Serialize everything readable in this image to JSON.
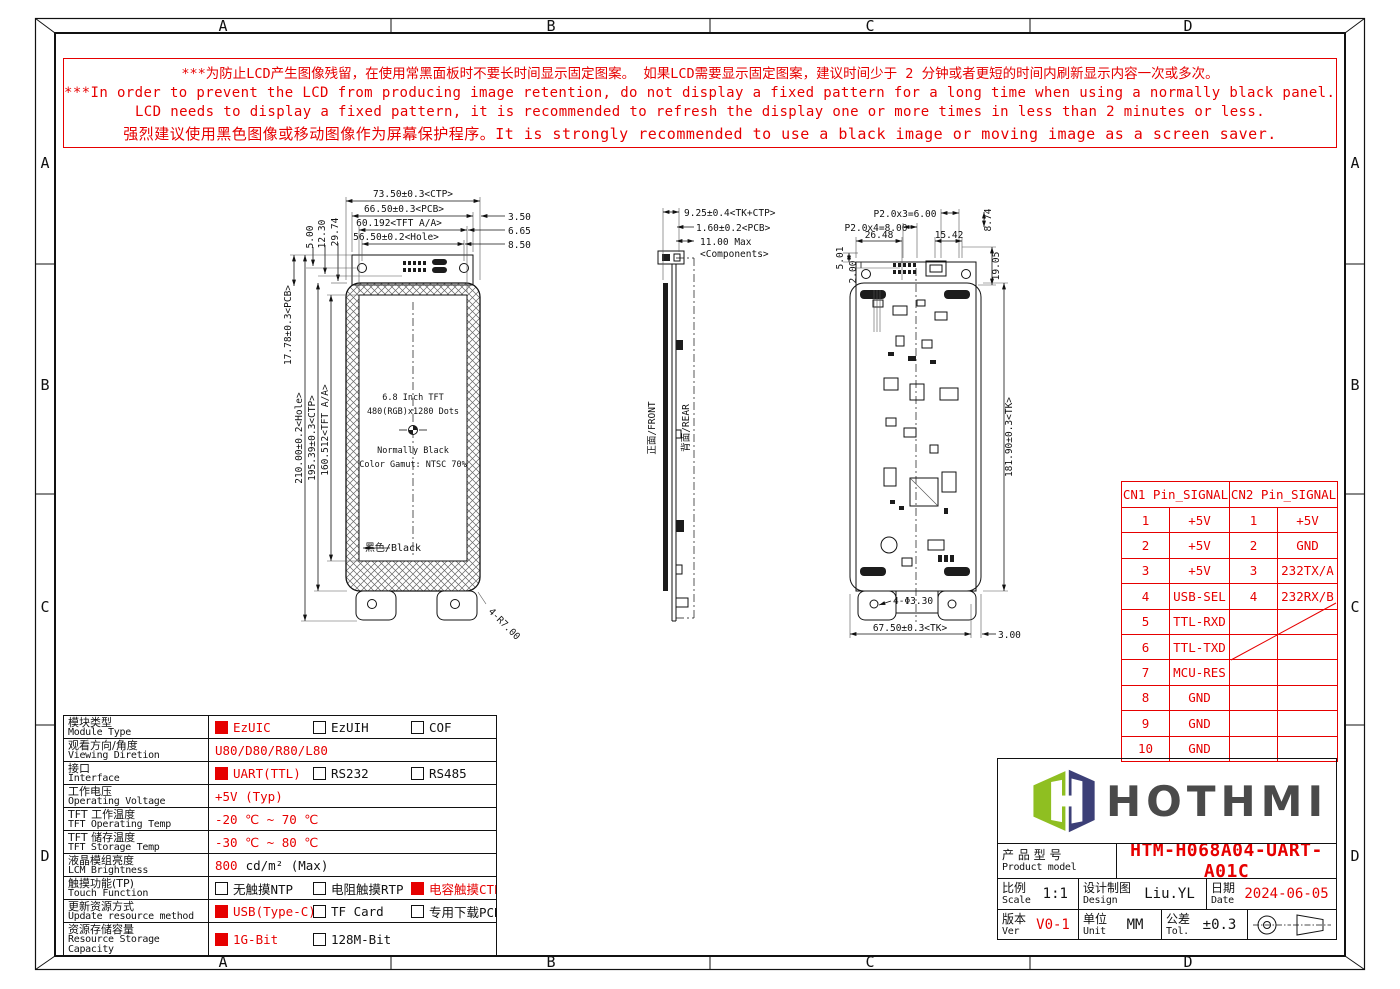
{
  "frame": {
    "cols": [
      "A",
      "B",
      "C",
      "D"
    ],
    "rows": [
      "A",
      "B",
      "C",
      "D"
    ]
  },
  "warning": {
    "line1": "***为防止LCD产生图像残留，在使用常黑面板时不要长时间显示固定图案。 如果LCD需要显示固定图案，建议时间少于 2 分钟或者更短的时间内刷新显示内容一次或多次。",
    "line2": "***In order to prevent the LCD from producing image retention, do not display a fixed pattern for a long time when using a normally black panel. If the",
    "line3": "LCD needs to display a fixed pattern, it is recommended to refresh the display one or more times in less than 2 minutes or less.",
    "line4": "强烈建议使用黑色图像或移动图像作为屏幕保护程序。It is strongly recommended to use a black image or moving image as a screen saver."
  },
  "front_view": {
    "dim_ctp": "73.50±0.3<CTP>",
    "dim_pcb": "66.50±0.3<PCB>",
    "dim_aa": "60.192<TFT A/A>",
    "dim_hole": "56.50±0.2<Hole>",
    "off1": "3.50",
    "off2": "6.65",
    "off3": "8.50",
    "v1": "5.00",
    "v2": "12.30",
    "v3": "29.74",
    "left1": "17.78±0.3<PCB>",
    "left2": "210.00±0.2<Hole>",
    "left3": "195.39±0.3<CTP>",
    "left4": "160.512<TFT A/A>",
    "screen1": "6.8 Inch TFT",
    "screen2": "480(RGB)x1280 Dots",
    "screen3": "Normally Black",
    "screen4": "Color Gamut: NTSC 70%",
    "black_label": "黑色/Black",
    "corner": "4-R7.00"
  },
  "side_view": {
    "dim1": "9.25±0.4<TK+CTP>",
    "dim2": "1.60±0.2<PCB>",
    "dim3": "11.00 Max",
    "dim3b": "<Components>",
    "front": "正面/FRONT",
    "rear": "背面/REAR"
  },
  "rear_view": {
    "p1": "P2.0x3=6.00",
    "p2": "P2.0x4=8.00",
    "d1": "26.48",
    "d2": "15.42",
    "d3": "8.74",
    "d4": "19.05",
    "d5": "5.01",
    "d6": "2.00",
    "right": "181.90±0.3<TK>",
    "hole": "4-Φ3.30",
    "bottom": "67.50±0.3<TK>",
    "off": "3.00"
  },
  "pin_table": {
    "h1": "CN1 Pin_SIGNAL",
    "h2": "CN2 Pin_SIGNAL",
    "cn1": [
      [
        "1",
        "+5V"
      ],
      [
        "2",
        "+5V"
      ],
      [
        "3",
        "+5V"
      ],
      [
        "4",
        "USB-SEL"
      ],
      [
        "5",
        "TTL-RXD"
      ],
      [
        "6",
        "TTL-TXD"
      ],
      [
        "7",
        "MCU-RES"
      ],
      [
        "8",
        "GND"
      ],
      [
        "9",
        "GND"
      ],
      [
        "10",
        "GND"
      ]
    ],
    "cn2": [
      [
        "1",
        "+5V"
      ],
      [
        "2",
        "GND"
      ],
      [
        "3",
        "232TX/A"
      ],
      [
        "4",
        "232RX/B"
      ]
    ]
  },
  "spec": {
    "rows": [
      {
        "cn": "模块类型",
        "en": "Module Type",
        "opts": [
          {
            "t": "EzUIC"
          },
          {
            "t": "EzUIH"
          },
          {
            "t": "COF"
          }
        ]
      },
      {
        "cn": "观看方向/角度",
        "en": "Viewing Diretion",
        "value": "U80/D80/R80/L80"
      },
      {
        "cn": "接口",
        "en": "Interface",
        "opts": [
          {
            "t": "UART(TTL)"
          },
          {
            "t": "RS232"
          },
          {
            "t": "RS485"
          }
        ]
      },
      {
        "cn": "工作电压",
        "en": "Operating Voltage",
        "value": "+5V (Typ)"
      },
      {
        "cn": "TFT 工作温度",
        "en": "TFT Operating Temp",
        "value": "-20 ℃ ~ 70 ℃"
      },
      {
        "cn": "TFT 储存温度",
        "en": "TFT Storage Temp",
        "value": "-30 ℃ ~ 80 ℃"
      },
      {
        "cn": "液晶模组亮度",
        "en": "LCM Brightness",
        "value_red": "800",
        "value_rest": "cd/m² (Max)"
      },
      {
        "cn": "触摸功能(TP)",
        "en": "Touch Function",
        "opts": [
          {
            "t": "无触摸NTP"
          },
          {
            "t": "电阻触摸RTP"
          },
          {
            "t": "电容触摸CTP"
          }
        ]
      },
      {
        "cn": "更新资源方式",
        "en": "Update resource method",
        "opts": [
          {
            "t": "USB(Type-C)"
          },
          {
            "t": "TF Card"
          },
          {
            "t": "专用下载PCB"
          }
        ]
      },
      {
        "cn": "资源存储容量",
        "en": "Resource Storage Capacity",
        "opts": [
          {
            "t": "1G-Bit"
          },
          {
            "t": "128M-Bit"
          }
        ]
      }
    ]
  },
  "title_block": {
    "brand": "HOTHMI",
    "product_cn": "产 品 型 号",
    "product_en": "Product model",
    "model": "HTM-H068A04-UART-A01C",
    "scale_cn": "比例",
    "scale_en": "Scale",
    "scale_value": "1:1",
    "design_cn": "设计制图",
    "design_en": "Design",
    "design_value": "Liu.YL",
    "date_cn": "日期",
    "date_en": "Date",
    "date_value": "2024-06-05",
    "ver_cn": "版本",
    "ver_en": "Ver",
    "ver_value": "V0-1",
    "unit_cn": "单位",
    "unit_en": "Unit",
    "unit_value": "MM",
    "tol_cn": "公差",
    "tol_en": "Tol.",
    "tol_value": "±0.3"
  },
  "colors": {
    "red": "#e60000",
    "line": "#111111",
    "logo_green": "#8fbf21",
    "logo_navy": "#3c3f77",
    "logo_text": "#4a4a4a"
  }
}
